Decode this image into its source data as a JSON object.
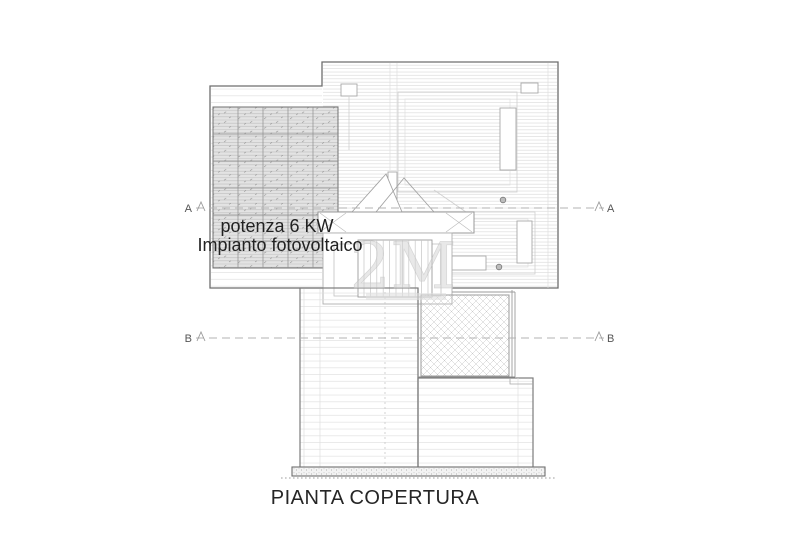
{
  "drawing": {
    "title": "PIANTA COPERTURA",
    "pv_annotation": {
      "line1": "potenza 6 KW",
      "line2": "Impianto fotovoltaico"
    },
    "watermark_text": "2M",
    "sections": {
      "a": {
        "label_left": "A",
        "label_right": "A"
      },
      "b": {
        "label_left": "B",
        "label_right": "B"
      }
    },
    "colors": {
      "background": "#ffffff",
      "outline": "#6d6d6d",
      "detail_line": "#a8a8a8",
      "tile_line_dense": "#d7d7d7",
      "tile_line_sparse": "#dcdcdc",
      "pv_fill": "#e3e3e3",
      "pv_grid": "#8d8d8d",
      "crosshatch_line": "#c9c9c9",
      "section_line": "#b3b3b3",
      "text": "#222222",
      "title_text": "#262626",
      "watermark": "#d2d2d2"
    }
  }
}
